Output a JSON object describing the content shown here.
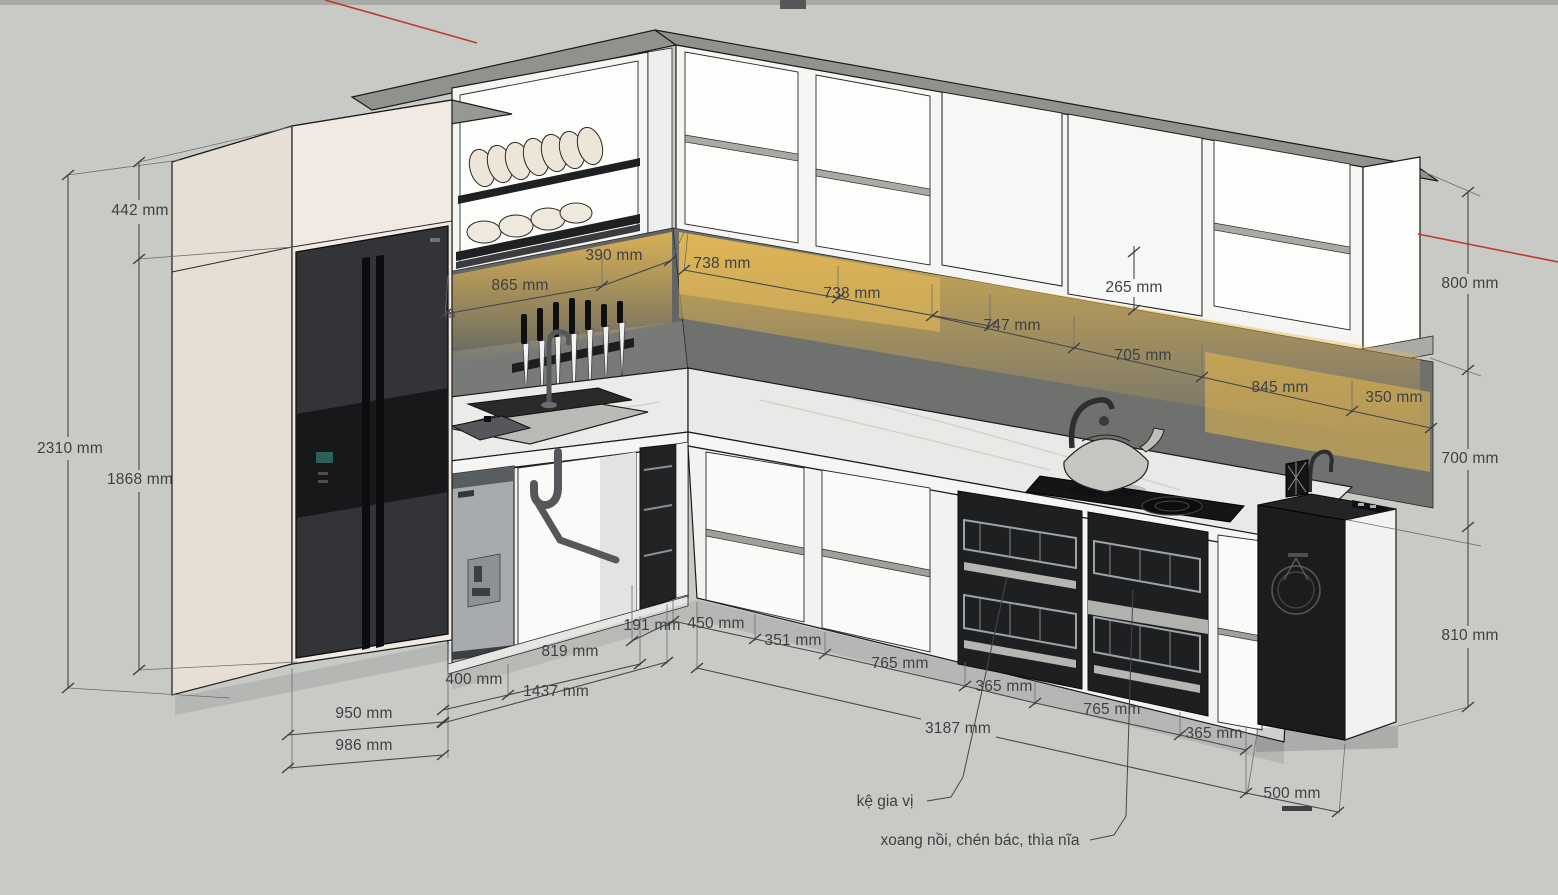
{
  "scene": {
    "type": "3d-kitchen-elevation-render",
    "background_color": "#c8cac6",
    "axis_red": "#bf3a2b",
    "led_glow": "#edbd54",
    "cabinet_white": "#f5f5f3",
    "cabinet_cream": "#e7dfd5",
    "backsplash_gray": "#6e716d",
    "appliance_black": "#1b1c1e"
  },
  "labels": {
    "dim_442": "442 mm",
    "dim_2310": "2310 mm",
    "dim_1868": "1868 mm",
    "dim_865": "865 mm",
    "dim_390": "390 mm",
    "dim_738_a": "738 mm",
    "dim_738_b": "738 mm",
    "dim_265": "265 mm",
    "dim_747": "747 mm",
    "dim_705": "705 mm",
    "dim_845": "845 mm",
    "dim_350": "350 mm",
    "dim_800": "800 mm",
    "dim_700": "700 mm",
    "dim_810": "810 mm",
    "dim_191": "191 mm",
    "dim_450": "450 mm",
    "dim_819": "819 mm",
    "dim_400": "400 mm",
    "dim_1437": "1437 mm",
    "dim_351": "351 mm",
    "dim_765_a": "765 mm",
    "dim_365_a": "365 mm",
    "dim_765_b": "765 mm",
    "dim_365_b": "365 mm",
    "dim_950": "950 mm",
    "dim_986": "986 mm",
    "dim_3187": "3187 mm",
    "dim_500": "500 mm",
    "partial_m": "m",
    "note_spice_rack": "kệ gia vị",
    "note_pots": "xoang nồi, chén bác, thìa nĩa"
  }
}
